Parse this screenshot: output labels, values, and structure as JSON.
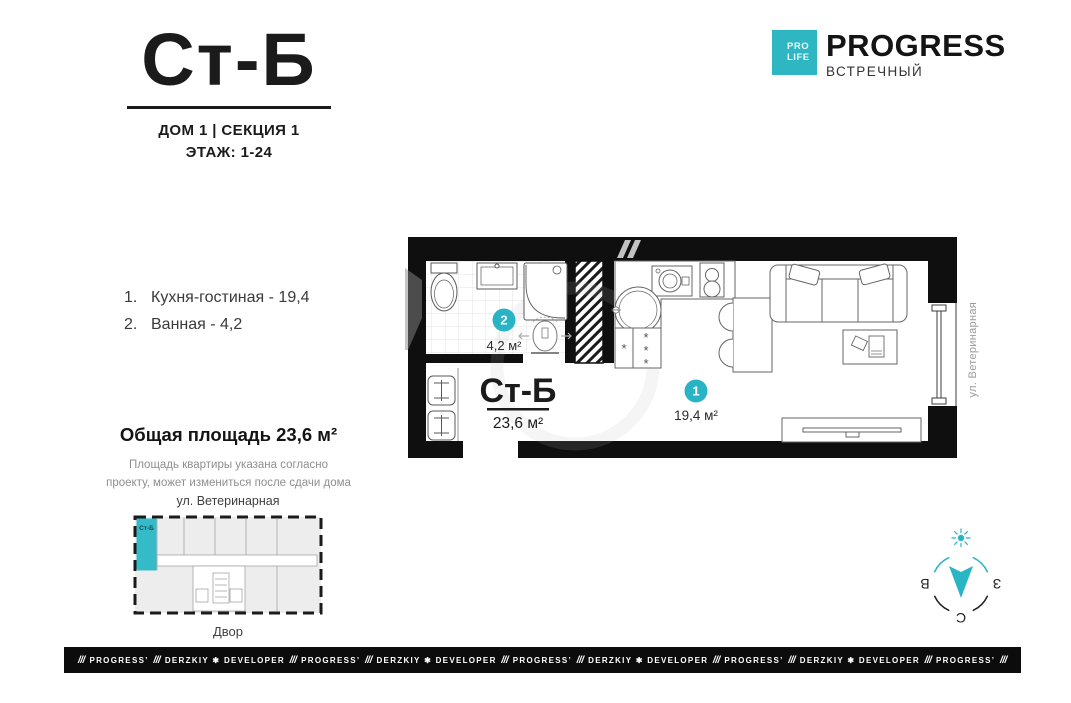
{
  "header": {
    "plan_code": "Ст-Б",
    "building_section": "ДОМ 1 | СЕКЦИЯ 1",
    "floors": "ЭТАЖ: 1-24"
  },
  "brand": {
    "badge_line1": "PRO",
    "badge_line2": "LIFE",
    "name": "PROGRESS",
    "project": "ВСТРЕЧНЫЙ",
    "accent_color": "#2eb6c3"
  },
  "room_list": [
    {
      "num": "1.",
      "label": "Кухня-гостиная - 19,4"
    },
    {
      "num": "2.",
      "label": "Ванная - 4,2"
    }
  ],
  "total_area": {
    "title": "Общая площадь 23,6 м²",
    "note_line1": "Площадь квартиры указана согласно",
    "note_line2": "проекту, может измениться после сдачи дома"
  },
  "site_plan": {
    "street": "ул. Ветеринарная",
    "unit_label": "Ст-Б",
    "yard": "Двор"
  },
  "floor_plan": {
    "unit_code": "Ст-Б",
    "total_area": "23,6 м²",
    "room1_number": "1",
    "room1_area": "19,4 м²",
    "room2_number": "2",
    "room2_area": "4,2 м²",
    "street_label": "ул. Ветеринарная"
  },
  "compass": {
    "east": "В",
    "west": "З",
    "north": "С"
  },
  "footer": {
    "items": [
      "///",
      "PROGRESS’",
      "///",
      "DERZKIY ✱ DEVELOPER",
      "///",
      "PROGRESS’",
      "///",
      "DERZKIY ✱ DEVELOPER",
      "///",
      "PROGRESS’",
      "///",
      "DERZKIY ✱ DEVELOPER",
      "///",
      "PROGRESS’",
      "///",
      "DERZKIY ✱ DEVELOPER",
      "///",
      "PROGRESS’",
      "///"
    ]
  }
}
